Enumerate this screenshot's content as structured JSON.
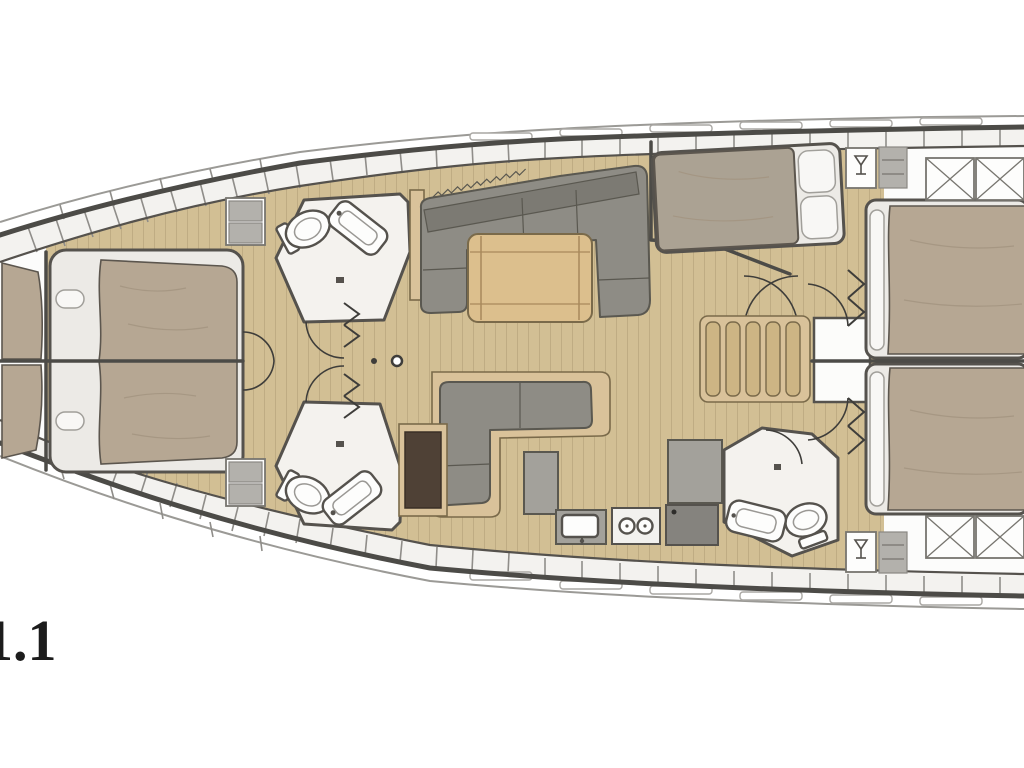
{
  "label": {
    "text": "1.1"
  },
  "colors": {
    "bg": "#ffffff",
    "hull": "#4c4b47",
    "deck-line": "#9b9a96",
    "band": "#f3f2ef",
    "interior": "#fcfcfb",
    "wall": "#55524d",
    "wood": "#d2bf94",
    "wood-line": "#b7a47c",
    "wood-furniture": "#d9c29a",
    "wood-dark": "#7a6a4a",
    "slat": "#cdb584",
    "table": "#dcbf8d",
    "sofa": "#8e8c85",
    "sofa-dark": "#7c7a73",
    "sofa-line": "#5a5850",
    "bed": "#b6a793",
    "midbed": "#aba293",
    "bed-edge": "#5c564e",
    "bed-shadow": "#a2937f",
    "mattress": "#eceae6",
    "fixture": "#f4f2ee",
    "counter": "#a3a19b",
    "appliance": "#85837e",
    "cabinet-brown": "#4f4136",
    "locker-gray": "#b3b1ac",
    "text": "#1c1c1c"
  }
}
